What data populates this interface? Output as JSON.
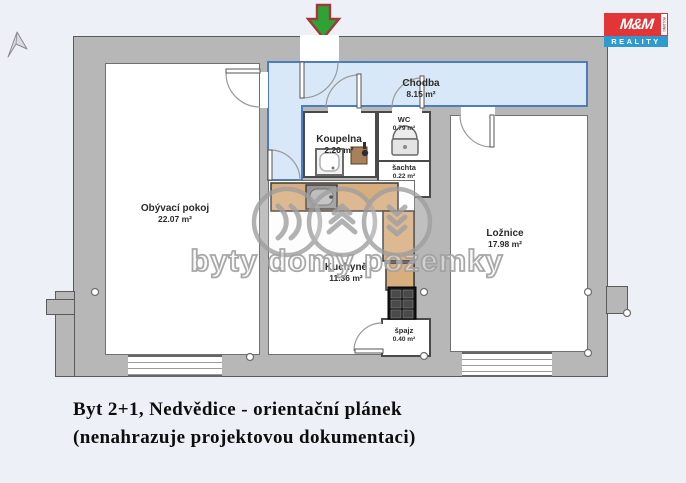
{
  "logo": {
    "top": "M&M",
    "holding": "HOLDING",
    "bottom": "REALITY"
  },
  "rooms": {
    "chodba": {
      "name": "Chodba",
      "area": "8.15 m²"
    },
    "koupelna": {
      "name": "Koupelna",
      "area": "2.20 m²"
    },
    "wc": {
      "name": "WC",
      "area": "0.79 m²"
    },
    "sachta": {
      "name": "šachta",
      "area": "0.22 m²"
    },
    "obyvaci_pokoj": {
      "name": "Obývací pokoj",
      "area": "22.07 m²"
    },
    "loznice": {
      "name": "Ložnice",
      "area": "17.98 m²"
    },
    "kuchyne": {
      "name": "Kuchyně",
      "area": "11.36 m²"
    },
    "spajz": {
      "name": "špajz",
      "area": "0.40 m²"
    }
  },
  "watermark": {
    "text": "byty domy pozemky"
  },
  "caption": {
    "line1": "Byt 2+1, Nedvědice - orientační plánek",
    "line2": "(nenahrazuje projektovou dokumentaci)"
  },
  "colors": {
    "wall": "#b7b7b7",
    "corridor_fill": "#d9e8f8",
    "corridor_border": "#4d7dc0",
    "counter": "#d9ae7e",
    "logo_red": "#e23537",
    "logo_blue": "#2f9ad0",
    "arrow_green": "#2fa236",
    "arrow_border": "#9f3a3a"
  }
}
